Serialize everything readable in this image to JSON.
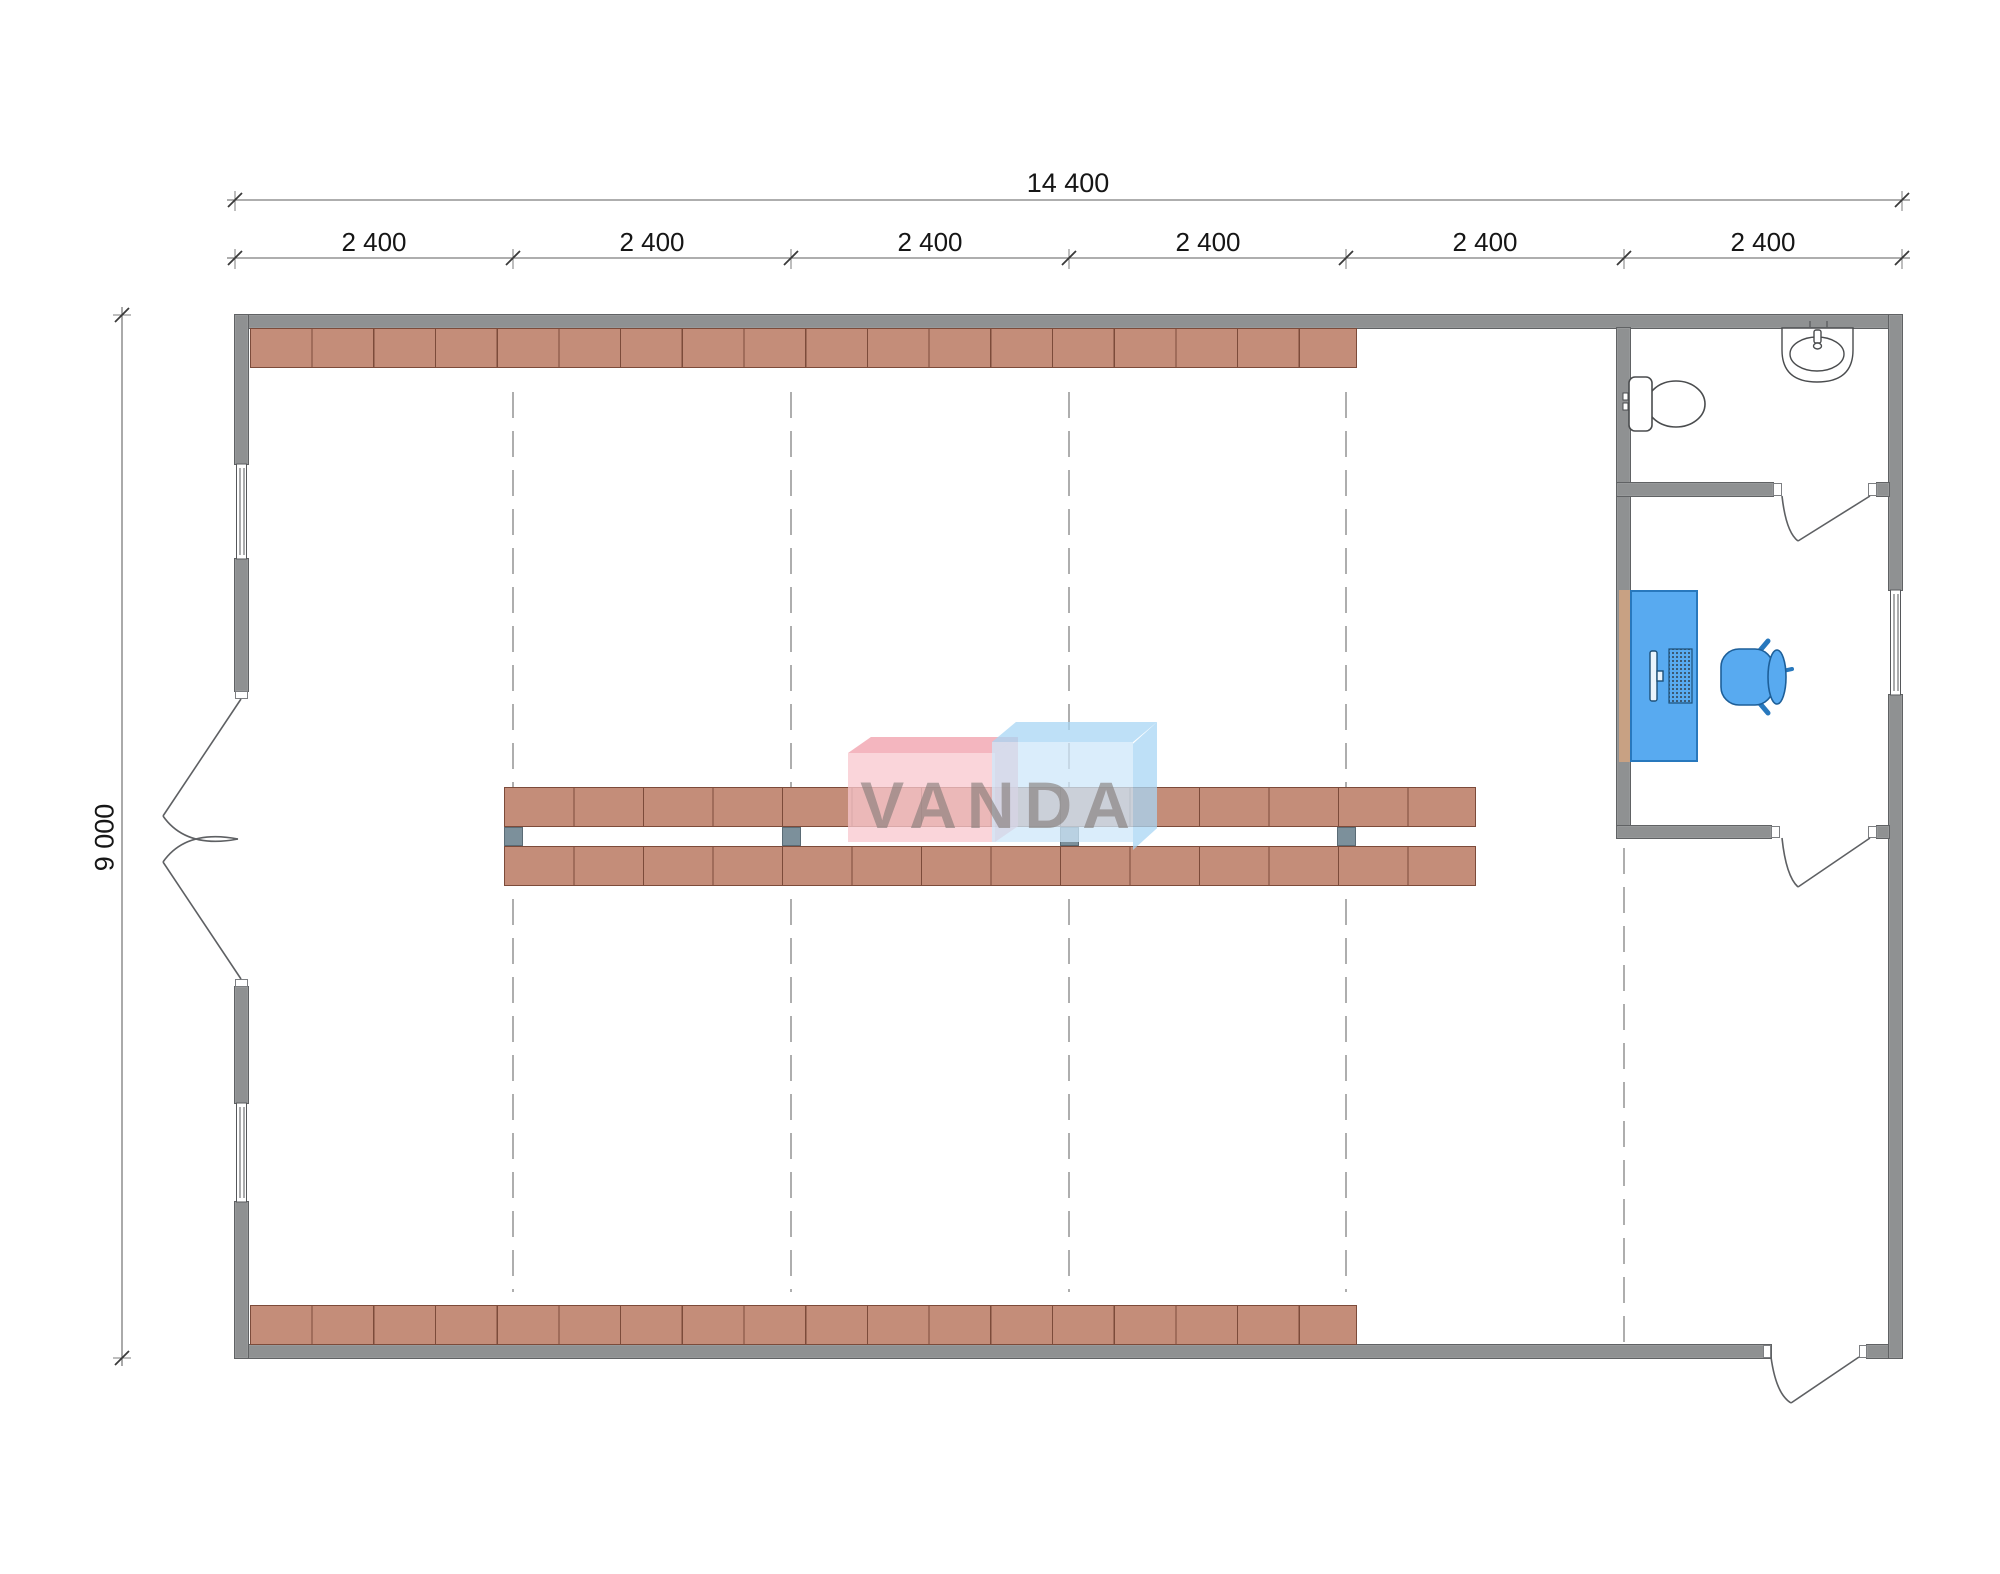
{
  "dimensions": {
    "overall_width": "14 400",
    "segments": [
      "2 400",
      "2 400",
      "2 400",
      "2 400",
      "2 400",
      "2 400"
    ],
    "overall_height": "9 000"
  },
  "watermark": {
    "text": "VANDA"
  },
  "icons": [
    "toilet-icon",
    "sink-icon",
    "monitor-icon",
    "keyboard-icon",
    "office-chair-icon",
    "door-swing-icon",
    "window-icon"
  ],
  "colors": {
    "wall": "#8f9192",
    "wall-edge": "#606264",
    "shelf": "#c48d79",
    "shelf-border": "#7c4b3a",
    "post": "#7c909b",
    "blue": "#58aaf0",
    "blue-border": "#2878bd",
    "tan": "#c8a183",
    "dash": "#8b8b8b",
    "dim": "#7d7d7d",
    "ink": "#161616",
    "wm-pink": "rgba(240,158,170,0.75)",
    "wm-pink-light": "rgba(248,199,206,0.75)",
    "wm-blue": "rgba(168,214,244,0.75)",
    "wm-blue-light": "rgba(206,231,249,0.75)",
    "wm-text": "rgba(128,120,116,0.6)"
  }
}
